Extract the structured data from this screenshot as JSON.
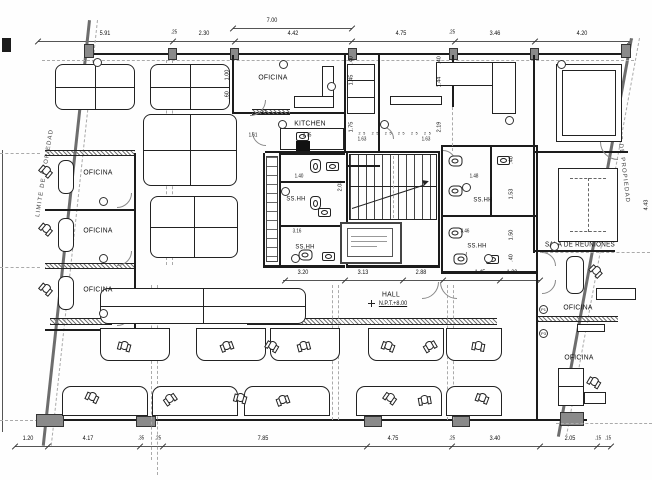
{
  "drawing": {
    "rooms": {
      "office_top_center": "OFICINA",
      "kitchen": "KITCHEN",
      "office_left_1": "OFICINA",
      "office_left_2": "OFICINA",
      "office_left_3": "OFICINA",
      "bath_left_upper": "SS.HH",
      "bath_left_lower": "SS.HH",
      "bath_right_upper": "SS.HH",
      "bath_right_lower": "SS.HH",
      "hall_label": "HALL",
      "hall_level": "N.P.T.+8.00",
      "meeting_room": "SALA DE REUNIONES",
      "office_right_mid": "OFICINA",
      "office_right_low": "OFICINA"
    },
    "boundaries": {
      "limit_left": "LIMITE DE PROPIEDAD",
      "limit_right": "LIMITE DE PROPIEDAD"
    },
    "keynotes": {
      "p1": "P1",
      "p3": "P3"
    },
    "dims": {
      "top_overall": "7.00",
      "top": [
        "5.91",
        "2.30",
        "4.42",
        "4.75",
        "3.46",
        "4.20"
      ],
      "top_small": [
        ".25",
        ".25"
      ],
      "middle": [
        "3.20",
        "3.13",
        "2.88",
        "1.45",
        "1.20"
      ],
      "bottom": [
        "1.20",
        "4.17",
        ".35",
        ".25",
        "7.85",
        "4.75",
        ".25",
        "3.40",
        "2.05",
        ".15",
        ".15"
      ],
      "interior": {
        "k1": "1.61",
        "k2": "2.75",
        "k3": ".77",
        "k4": "1.00",
        "k5": ".60",
        "v1": ".40",
        "v2": "1.45",
        "v3": "1.75",
        "v4": ".40",
        "v5": "1.44",
        "v6": "2.19",
        "s1": "1.63",
        "s2": "1.63",
        "s3": "2.03",
        "b1": "1.40",
        "b2": "3.16",
        "b3": "1.48",
        "b4": "3.46",
        "r1": ".40",
        "r2": "1.53",
        "r3": "1.50",
        "r4": ".40",
        "e1": "4.43"
      },
      "stair_treads": "25 25 25 25 25 25"
    },
    "colors": {
      "line": "#1c1c1c",
      "structure": "#6d6d6d",
      "hatch": "#777777"
    }
  }
}
